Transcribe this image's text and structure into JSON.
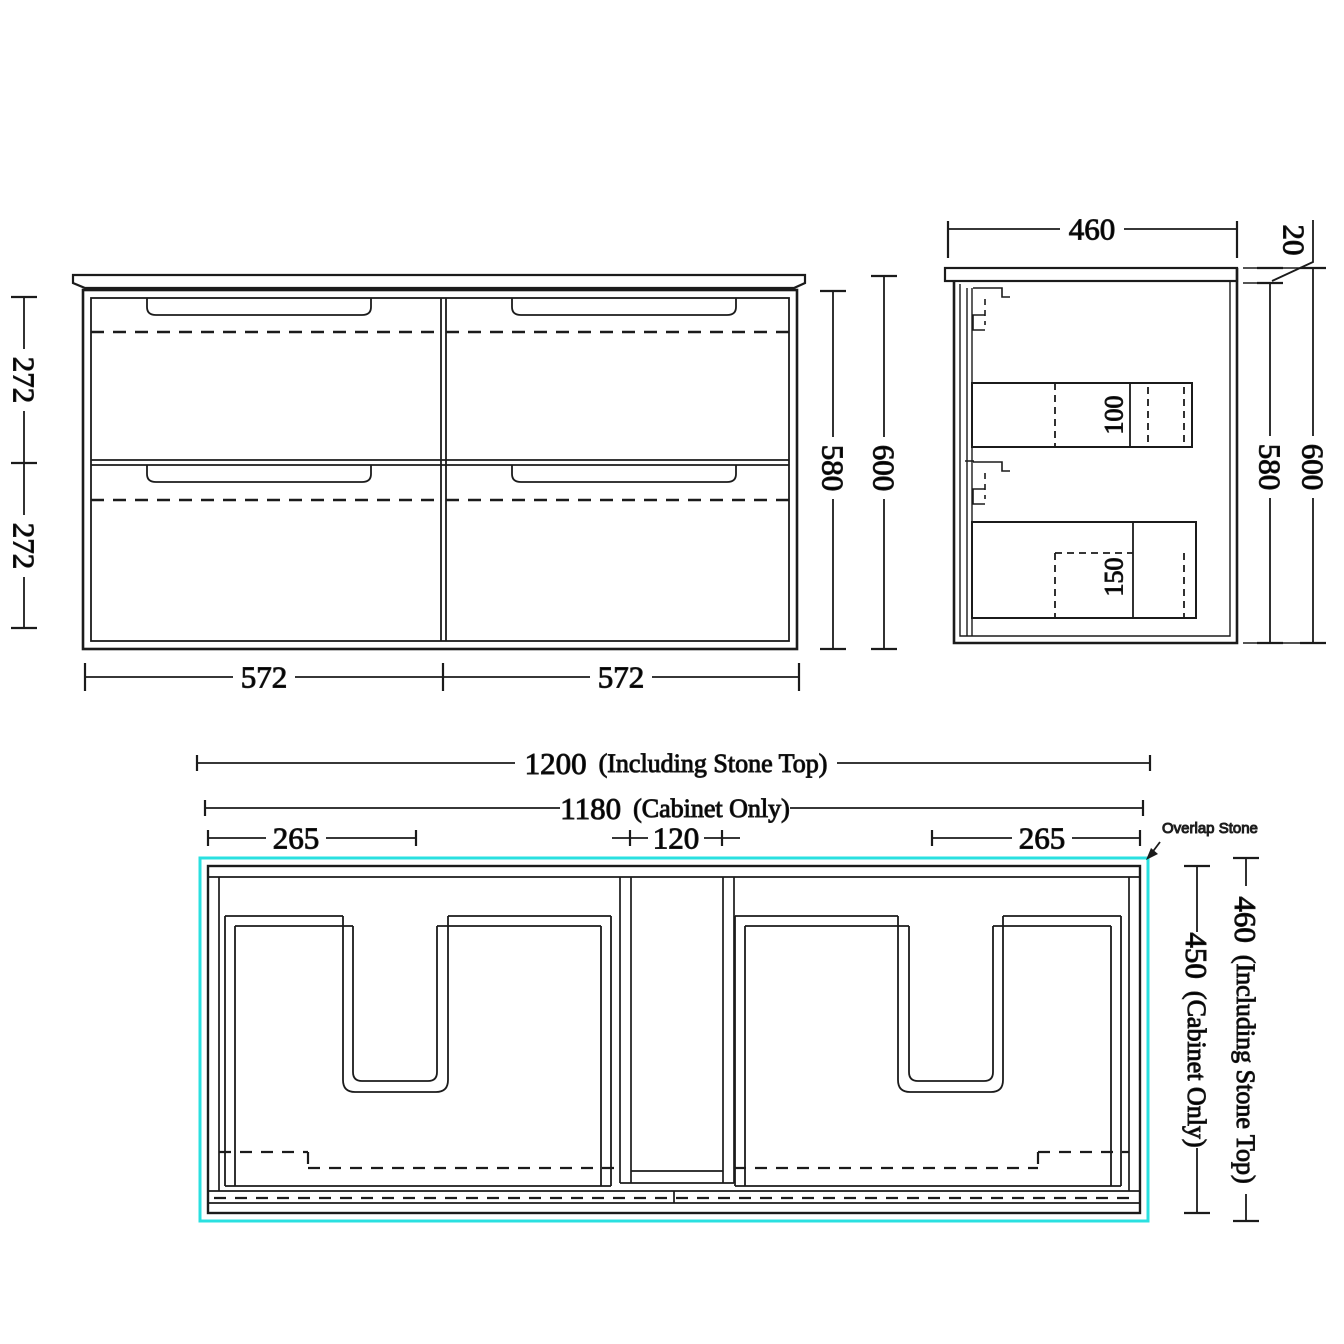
{
  "drawing": {
    "background": "#ffffff",
    "line_color": "#1b1b1b",
    "stone_outline_color": "#2ae0e0",
    "front_view": {
      "drawer_height_top": "272",
      "drawer_height_bottom": "272",
      "cabinet_height": "580",
      "overall_height": "600",
      "drawer_width_left": "572",
      "drawer_width_right": "572"
    },
    "side_view": {
      "depth": "460",
      "stone_thickness": "20",
      "cabinet_height": "580",
      "overall_height": "600",
      "upper_drawer_dim": "100",
      "lower_drawer_dim": "150"
    },
    "plan_view": {
      "overall_width": {
        "value": "1200",
        "note": "(Including Stone Top)"
      },
      "cabinet_width": {
        "value": "1180",
        "note": "(Cabinet Only)"
      },
      "left_offset": "265",
      "center_gap": "120",
      "right_offset": "265",
      "cabinet_depth": {
        "value": "450",
        "note": "(Cabinet Only)"
      },
      "overall_depth": {
        "value": "460",
        "note": "(Including Stone Top)"
      },
      "overlap_label": "Overlap Stone"
    }
  }
}
